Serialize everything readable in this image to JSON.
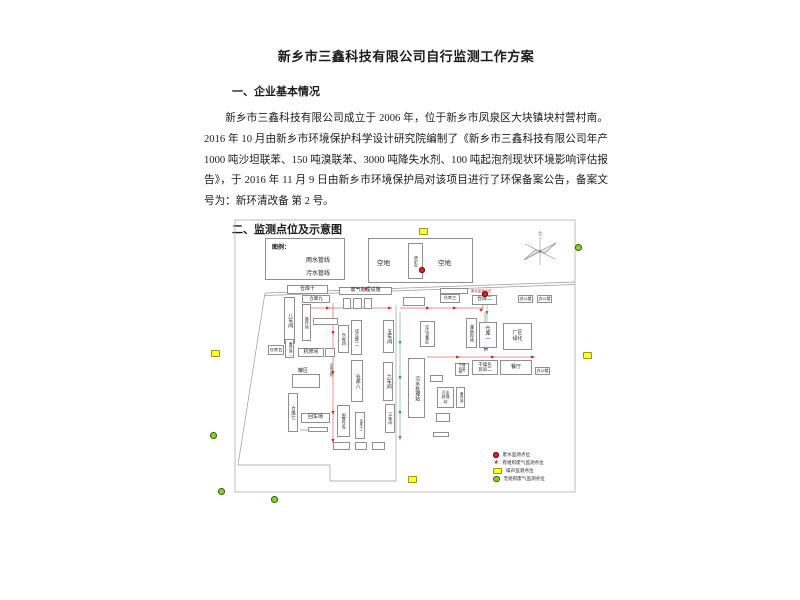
{
  "document": {
    "title": "新乡市三鑫科技有限公司自行监测工作方案",
    "section1_heading": "一、企业基本情况",
    "paragraph": "新乡市三鑫科技有限公司成立于 2006 年，位于新乡市凤泉区大块镇块村营村南。2016 年 10 月由新乡市环境保护科学设计研究院编制了《新乡市三鑫科技有限公司年产 1000 吨沙坦联苯、150 吨溴联苯、3000 吨降失水剂、100 吨起泡剂现状环境影响评估报告》，于 2016 年 11 月 9 日由新乡市环境保护局对该项目进行了环保备案公告，备案文号为：新环清改备 第 2 号。",
    "section2_heading": "二、监测点位及示意图"
  },
  "diagram": {
    "pipe_legend": {
      "title": "图例：",
      "items": [
        {
          "label": "雨水管线",
          "color": "#cc2222"
        },
        {
          "label": "污水管线",
          "color": "#2e9e5b"
        }
      ]
    },
    "compass_label": "北",
    "areas": {
      "open": "空地",
      "boiler": "锅炉房"
    },
    "buildings": {
      "w1": "仓库一",
      "w2": "仓库二",
      "w3": "仓库三",
      "w4": "仓库四",
      "w5": "仓库五",
      "w7": "仓库七",
      "w8": "仓库八",
      "w9": "仓库九",
      "w10": "仓库十",
      "w11": "仓库十一",
      "ws3": "三车间",
      "ws5": "五车间",
      "ws6": "六车间",
      "ws8": "八车间",
      "czj": "操作间",
      "bjk2": "备件库二",
      "jxj": "机修间",
      "gq": "罐区",
      "hcc": "回车场",
      "ysdl": "运输道路",
      "cpk2": "成品库二",
      "fqclss": "废气处理设施",
      "xzck": "闲置仓库",
      "wscl": "污水处理站",
      "kysbq": "空压设备区",
      "gzxc": "灌装现场",
      "cqlh": "厂区绿化",
      "bgl": "办公楼",
      "gzbzj1": "干燥包装间一",
      "gzbzj2": "干燥包装间二",
      "ct": "餐厅",
      "bjk": "备件库"
    },
    "outfall_label": "废水监测点位",
    "point_legend": [
      {
        "symbol": "red-dot",
        "label": "废水监测点位",
        "color": "#cc2222"
      },
      {
        "symbol": "red-star",
        "label": "有组织废气监测点位",
        "color": "#cc2222"
      },
      {
        "symbol": "yellow-rect",
        "label": "噪声监测点位",
        "color": "#ffff33"
      },
      {
        "symbol": "green-circle",
        "label": "无组织废气监测点位",
        "color": "#88cc33"
      }
    ]
  }
}
